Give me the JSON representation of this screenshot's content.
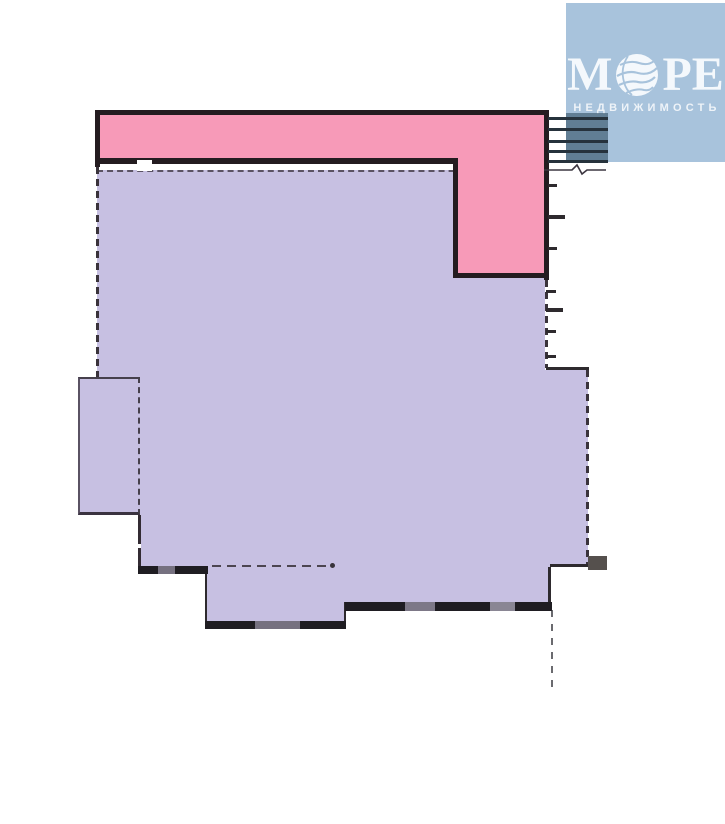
{
  "window": {
    "width_px": 725,
    "height_px": 824,
    "background": "#ffffff"
  },
  "logo": {
    "brand_prefix": "М",
    "brand_suffix": "РЕ",
    "subtitle": "НЕДВИЖИМОСТЬ",
    "globe_icon": "globe-sphere-icon",
    "colors": {
      "background": "#a8c3dc",
      "text": "#f4f8fc"
    }
  },
  "floor_plan": {
    "colors": {
      "room_pink": "#f79ab8",
      "room_purple": "#c7c0e2",
      "wall_dark": "#241c20",
      "wall_thin": "#4a4350",
      "window_dark": "#1f1d22",
      "window_light": "#7d7887",
      "stair_line": "#26323c",
      "stair_shade": "rgba(25,58,76,0.5)"
    },
    "stairs": {
      "steps": 5
    }
  }
}
